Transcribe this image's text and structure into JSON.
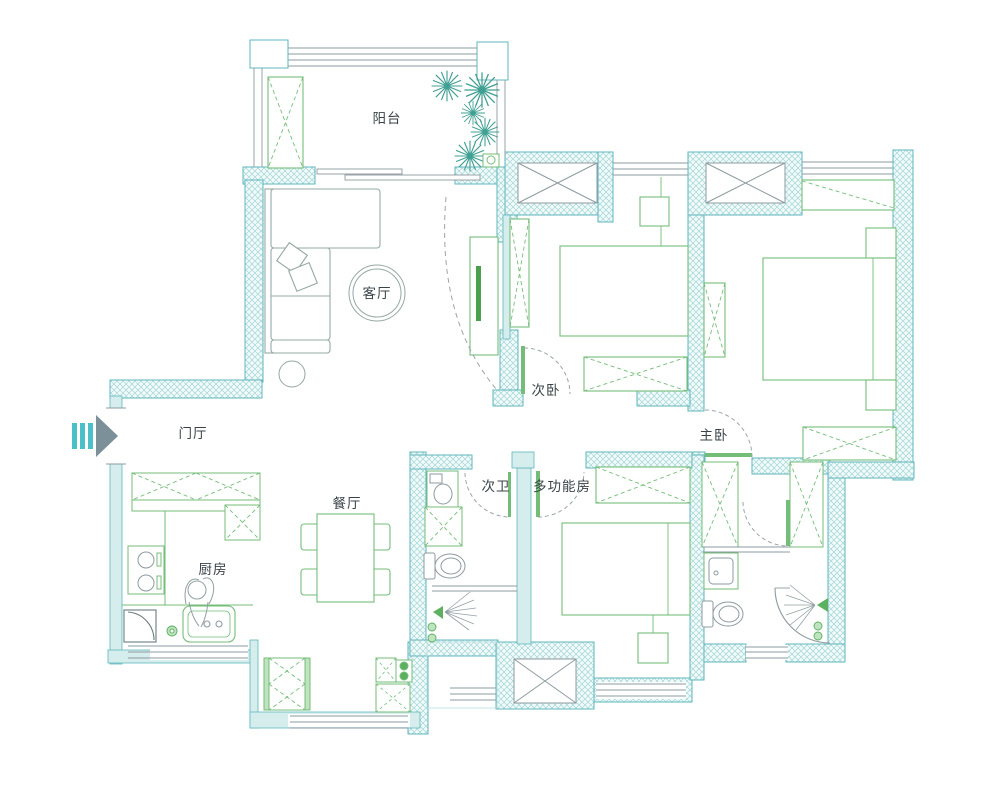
{
  "plan": {
    "type": "residential floor plan",
    "rooms": [
      {
        "id": "balcony",
        "label": "阳台"
      },
      {
        "id": "living-room",
        "label": "客厅"
      },
      {
        "id": "entry-hall",
        "label": "门厅"
      },
      {
        "id": "dining-room",
        "label": "餐厅"
      },
      {
        "id": "kitchen",
        "label": "厨房"
      },
      {
        "id": "secondary-bedroom",
        "label": "次卧"
      },
      {
        "id": "master-bedroom",
        "label": "主卧"
      },
      {
        "id": "secondary-bathroom",
        "label": "次卫"
      },
      {
        "id": "multi-function-room",
        "label": "多功能房"
      }
    ],
    "colors": {
      "wall_stroke": "#5fb7bc",
      "wall_hatch": "#a2d6d8",
      "furniture": "#74bd79",
      "gray_line": "#8d9ba0",
      "label_text": "#3a4347",
      "entry_arrow": "#4cc0c8",
      "entry_arrowhead": "#7b9099",
      "plant": "#3f9f92",
      "background": "#ffffff"
    }
  }
}
